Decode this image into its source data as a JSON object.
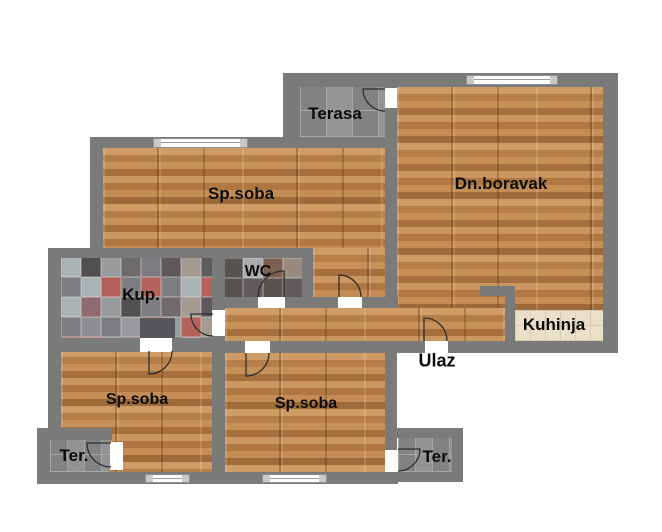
{
  "floorplan": {
    "background": "#ffffff",
    "colors": {
      "wall": "#7a7a7a",
      "door_arc": "#2f2f2f",
      "wood_base": "#c18a55",
      "tile_grey": "#8f8f8f",
      "tile_cream": "#eadfc8",
      "window_white": "#ffffff",
      "label_text": "#0b0b0b"
    },
    "floors": [
      {
        "name": "terasa-floor",
        "type": "tile-lg",
        "x": 300,
        "y": 87,
        "w": 85,
        "h": 50
      },
      {
        "name": "sp-soba-tl-floor",
        "type": "wood",
        "x": 103,
        "y": 148,
        "w": 282,
        "h": 100
      },
      {
        "name": "sp-soba-tl-ext-floor",
        "type": "wood",
        "x": 313,
        "y": 248,
        "w": 72,
        "h": 49
      },
      {
        "name": "dn-boravak-floor",
        "type": "wood",
        "x": 397,
        "y": 87,
        "w": 206,
        "h": 254
      },
      {
        "name": "hall-floor",
        "type": "wood",
        "x": 225,
        "y": 308,
        "w": 280,
        "h": 33
      },
      {
        "name": "kup-floor",
        "type": "patch",
        "x": 61,
        "y": 257,
        "w": 151,
        "h": 81,
        "tile": 20,
        "palette": [
          "#999b9e",
          "#5d595b",
          "#aab3b3",
          "#6f6b6d",
          "#8e8f93",
          "#52504f",
          "#b5635a",
          "#8f6b70",
          "#a39a92",
          "#c3746c",
          "#7c7d82",
          "#5f5c60"
        ]
      },
      {
        "name": "wc-floor",
        "type": "patch",
        "x": 223,
        "y": 258,
        "w": 79,
        "h": 39,
        "tile": 20,
        "palette": [
          "#a0a2a7",
          "#6c6869",
          "#57534f",
          "#909094",
          "#7e6053",
          "#ababaf",
          "#605c5e",
          "#988a7f"
        ]
      },
      {
        "name": "kuhinja-floor",
        "type": "tile-cream",
        "x": 515,
        "y": 310,
        "w": 88,
        "h": 31
      },
      {
        "name": "sp-soba-bl-floor",
        "type": "wood",
        "x": 61,
        "y": 350,
        "w": 151,
        "h": 122
      },
      {
        "name": "sp-soba-bm-floor",
        "type": "wood",
        "x": 225,
        "y": 353,
        "w": 160,
        "h": 119
      },
      {
        "name": "ter-bl-floor",
        "type": "tile-sm",
        "x": 50,
        "y": 440,
        "w": 60,
        "h": 32
      },
      {
        "name": "ter-br-floor",
        "type": "tile-sm",
        "x": 398,
        "y": 438,
        "w": 54,
        "h": 34
      }
    ],
    "fixtures": [
      {
        "name": "kup-fixture",
        "x": 140,
        "y": 318,
        "w": 35,
        "h": 20,
        "color": "#57555a"
      }
    ],
    "walls": [
      {
        "name": "outer-top-wall",
        "x": 283,
        "y": 73,
        "w": 335,
        "h": 14
      },
      {
        "name": "terasa-left-wall",
        "x": 283,
        "y": 73,
        "w": 17,
        "h": 75
      },
      {
        "name": "upper-mid-wall",
        "x": 90,
        "y": 137,
        "w": 307,
        "h": 11
      },
      {
        "name": "outer-left-upper-wall",
        "x": 90,
        "y": 137,
        "w": 13,
        "h": 121
      },
      {
        "name": "left-jog-wall",
        "x": 48,
        "y": 248,
        "w": 55,
        "h": 10
      },
      {
        "name": "outer-left-mid-wall",
        "x": 48,
        "y": 248,
        "w": 13,
        "h": 182
      },
      {
        "name": "outer-left-ter-wall",
        "x": 37,
        "y": 428,
        "w": 13,
        "h": 56
      },
      {
        "name": "ter-bl-top-wall",
        "x": 37,
        "y": 428,
        "w": 75,
        "h": 12
      },
      {
        "name": "outer-bottom-wall",
        "x": 37,
        "y": 472,
        "w": 361,
        "h": 12
      },
      {
        "name": "kup-wc-top-wall",
        "x": 48,
        "y": 248,
        "w": 265,
        "h": 10
      },
      {
        "name": "mid-vertical-wall",
        "x": 212,
        "y": 248,
        "w": 13,
        "h": 224
      },
      {
        "name": "wc-right-wall",
        "x": 302,
        "y": 248,
        "w": 11,
        "h": 60
      },
      {
        "name": "hall-top-wall",
        "x": 212,
        "y": 297,
        "w": 186,
        "h": 11
      },
      {
        "name": "kup-bottom-wall",
        "x": 48,
        "y": 338,
        "w": 177,
        "h": 14
      },
      {
        "name": "hall-bottom-wall",
        "x": 212,
        "y": 341,
        "w": 406,
        "h": 12
      },
      {
        "name": "divider-right-wall",
        "x": 385,
        "y": 73,
        "w": 12,
        "h": 235
      },
      {
        "name": "outer-right-wall",
        "x": 603,
        "y": 73,
        "w": 15,
        "h": 280
      },
      {
        "name": "kitchen-l-horizontal-wall",
        "x": 480,
        "y": 286,
        "w": 35,
        "h": 10
      },
      {
        "name": "kitchen-l-vertical-wall",
        "x": 505,
        "y": 286,
        "w": 10,
        "h": 56
      },
      {
        "name": "sp-bm-right-wall",
        "x": 385,
        "y": 352,
        "w": 12,
        "h": 98
      },
      {
        "name": "ter-br-top-wall",
        "x": 393,
        "y": 428,
        "w": 70,
        "h": 10
      },
      {
        "name": "ter-br-right-wall",
        "x": 452,
        "y": 428,
        "w": 11,
        "h": 54
      },
      {
        "name": "ter-br-bottom-wall",
        "x": 393,
        "y": 472,
        "w": 70,
        "h": 10
      }
    ],
    "door_gaps": [
      {
        "name": "terasa-door-gap",
        "x": 385,
        "y": 88,
        "w": 12,
        "h": 20
      },
      {
        "name": "wc-door-gap",
        "x": 258,
        "y": 297,
        "w": 27,
        "h": 11
      },
      {
        "name": "sp-tl-door-gap",
        "x": 338,
        "y": 297,
        "w": 24,
        "h": 11
      },
      {
        "name": "kup-door-gap",
        "x": 212,
        "y": 310,
        "w": 13,
        "h": 26
      },
      {
        "name": "sp-bl-door-gap",
        "x": 140,
        "y": 338,
        "w": 32,
        "h": 14
      },
      {
        "name": "sp-bm-door-gap",
        "x": 245,
        "y": 341,
        "w": 25,
        "h": 12
      },
      {
        "name": "ulaz-door-gap",
        "x": 425,
        "y": 341,
        "w": 23,
        "h": 12
      },
      {
        "name": "ter-bl-door-gap",
        "x": 110,
        "y": 442,
        "w": 13,
        "h": 28
      },
      {
        "name": "ter-br-door-gap",
        "x": 385,
        "y": 450,
        "w": 12,
        "h": 22
      }
    ],
    "windows": [
      {
        "name": "sp-tl-window",
        "x": 153,
        "y": 138,
        "w": 95,
        "h": 10
      },
      {
        "name": "dn-boravak-window",
        "x": 466,
        "y": 75,
        "w": 92,
        "h": 10
      },
      {
        "name": "sp-bl-window",
        "x": 145,
        "y": 474,
        "w": 45,
        "h": 9
      },
      {
        "name": "sp-bm-window",
        "x": 262,
        "y": 474,
        "w": 65,
        "h": 9
      }
    ],
    "door_arcs": [
      {
        "name": "terasa-door-arc",
        "px": 385,
        "py": 89,
        "r": 22,
        "leaf": "left",
        "sweep": 0
      },
      {
        "name": "wc-door-arc",
        "px": 284,
        "py": 297,
        "r": 26,
        "leaf": "up",
        "sweep": 0
      },
      {
        "name": "sp-tl-door-arc",
        "px": 339,
        "py": 297,
        "r": 22,
        "leaf": "up",
        "sweep": 1
      },
      {
        "name": "kup-door-arc",
        "px": 213,
        "py": 314,
        "r": 22,
        "leaf": "left",
        "sweep": 0
      },
      {
        "name": "sp-bl-door-arc",
        "px": 149,
        "py": 351,
        "r": 23,
        "leaf": "down",
        "sweep": 0
      },
      {
        "name": "sp-bm-door-arc",
        "px": 246,
        "py": 353,
        "r": 23,
        "leaf": "down",
        "sweep": 0
      },
      {
        "name": "ulaz-door-arc",
        "px": 424,
        "py": 341,
        "r": 23,
        "leaf": "up",
        "sweep": 1
      },
      {
        "name": "ter-bl-door-arc",
        "px": 111,
        "py": 443,
        "r": 24,
        "leaf": "left",
        "sweep": 0
      },
      {
        "name": "ter-br-door-arc",
        "px": 398,
        "py": 449,
        "r": 22,
        "leaf": "right",
        "sweep": 1
      }
    ],
    "labels": [
      {
        "name": "label-terasa",
        "text": "Terasa",
        "x": 335,
        "y": 114,
        "size": 17
      },
      {
        "name": "label-sp-soba-tl",
        "text": "Sp.soba",
        "x": 241,
        "y": 194,
        "size": 17
      },
      {
        "name": "label-dn-boravak",
        "text": "Dn.boravak",
        "x": 501,
        "y": 184,
        "size": 17
      },
      {
        "name": "label-kup",
        "text": "Kup.",
        "x": 141,
        "y": 295,
        "size": 17
      },
      {
        "name": "label-wc",
        "text": "WC",
        "x": 258,
        "y": 272,
        "size": 16
      },
      {
        "name": "label-kuhinja",
        "text": "Kuhinja",
        "x": 554,
        "y": 325,
        "size": 17
      },
      {
        "name": "label-ulaz",
        "text": "Ulaz",
        "x": 437,
        "y": 361,
        "size": 18
      },
      {
        "name": "label-sp-soba-bl",
        "text": "Sp.soba",
        "x": 137,
        "y": 400,
        "size": 16
      },
      {
        "name": "label-sp-soba-bm",
        "text": "Sp.soba",
        "x": 306,
        "y": 404,
        "size": 16
      },
      {
        "name": "label-ter-bl",
        "text": "Ter.",
        "x": 74,
        "y": 456,
        "size": 17
      },
      {
        "name": "label-ter-br",
        "text": "Ter.",
        "x": 437,
        "y": 457,
        "size": 17
      }
    ]
  }
}
